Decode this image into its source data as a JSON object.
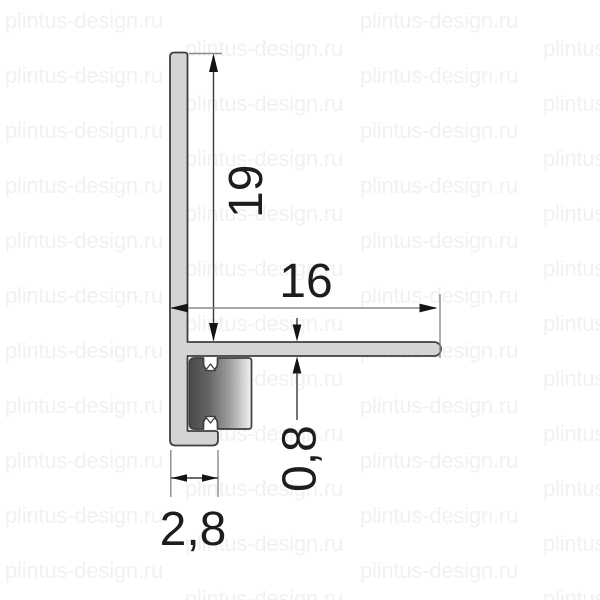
{
  "watermark": {
    "text": "plintus-design.ru"
  },
  "drawing": {
    "dimensions": {
      "height_mm": "19",
      "depth_mm": "16",
      "flange_thickness_mm": "0,8",
      "base_width_mm": "2,8"
    },
    "colors": {
      "profile_fill": "#d4d4d6",
      "profile_outline": "#3f3f3f",
      "insert_gradient_dark": "#4a4a4a",
      "insert_gradient_mid": "#9f9f9f",
      "insert_gradient_light": "#f2f2f2",
      "dimension_line": "#8a8a8a",
      "dimension_dark_line": "#3a3a3a",
      "arrowhead": "#141414",
      "dimension_text": "#1d1d1d",
      "watermark": "#f1f1f1"
    }
  }
}
